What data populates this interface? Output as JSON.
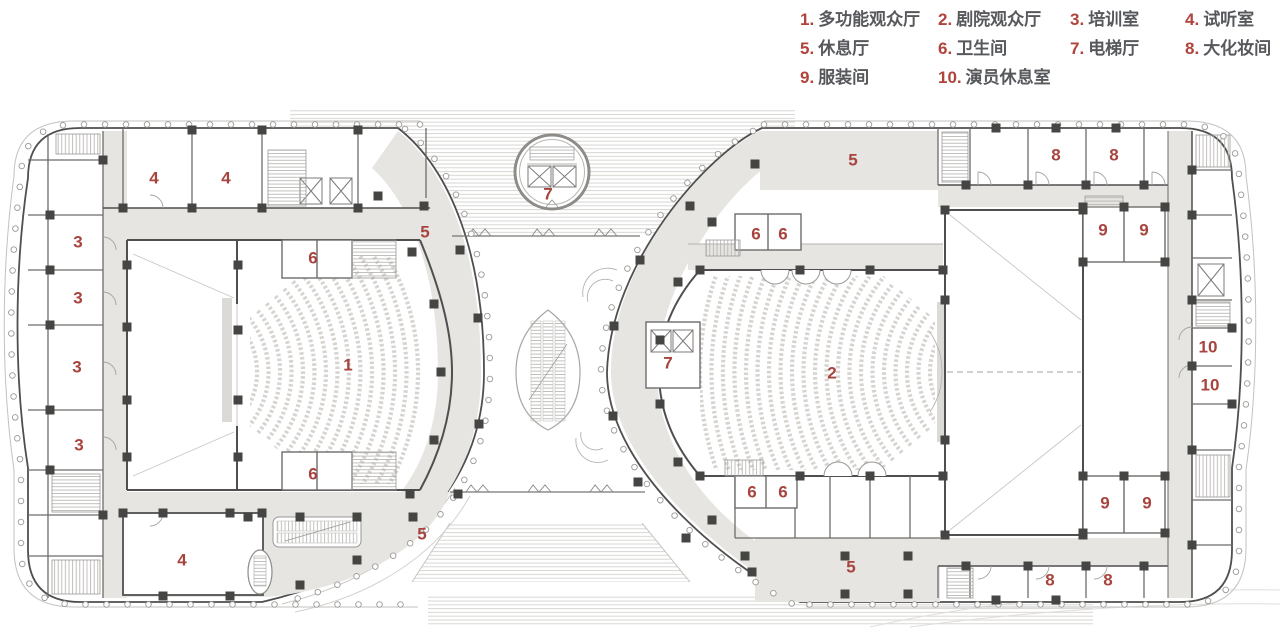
{
  "legend": {
    "items": [
      {
        "num": "1.",
        "label": "多功能观众厅"
      },
      {
        "num": "2.",
        "label": "剧院观众厅"
      },
      {
        "num": "3.",
        "label": "培训室"
      },
      {
        "num": "4.",
        "label": "试听室"
      },
      {
        "num": "5.",
        "label": "休息厅"
      },
      {
        "num": "6.",
        "label": "卫生间"
      },
      {
        "num": "7.",
        "label": "电梯厅"
      },
      {
        "num": "8.",
        "label": "大化妆间"
      },
      {
        "num": "9.",
        "label": "服装间"
      },
      {
        "num": "10.",
        "label": "演员休息室"
      }
    ]
  },
  "plan": {
    "room_labels": [
      {
        "t": "1",
        "x": 348,
        "y": 365
      },
      {
        "t": "2",
        "x": 832,
        "y": 373
      },
      {
        "t": "3",
        "x": 78,
        "y": 242
      },
      {
        "t": "3",
        "x": 78,
        "y": 298
      },
      {
        "t": "3",
        "x": 77,
        "y": 367
      },
      {
        "t": "3",
        "x": 79,
        "y": 445
      },
      {
        "t": "4",
        "x": 154,
        "y": 178
      },
      {
        "t": "4",
        "x": 226,
        "y": 178
      },
      {
        "t": "4",
        "x": 182,
        "y": 560
      },
      {
        "t": "5",
        "x": 425,
        "y": 232
      },
      {
        "t": "5",
        "x": 422,
        "y": 534
      },
      {
        "t": "5",
        "x": 853,
        "y": 160
      },
      {
        "t": "5",
        "x": 851,
        "y": 567
      },
      {
        "t": "6",
        "x": 313,
        "y": 258
      },
      {
        "t": "6",
        "x": 313,
        "y": 474
      },
      {
        "t": "6",
        "x": 756,
        "y": 234
      },
      {
        "t": "6",
        "x": 783,
        "y": 234
      },
      {
        "t": "6",
        "x": 752,
        "y": 492
      },
      {
        "t": "6",
        "x": 783,
        "y": 492
      },
      {
        "t": "7",
        "x": 548,
        "y": 194
      },
      {
        "t": "7",
        "x": 668,
        "y": 363
      },
      {
        "t": "8",
        "x": 1056,
        "y": 155
      },
      {
        "t": "8",
        "x": 1114,
        "y": 155
      },
      {
        "t": "8",
        "x": 1050,
        "y": 580
      },
      {
        "t": "8",
        "x": 1108,
        "y": 580
      },
      {
        "t": "9",
        "x": 1103,
        "y": 230
      },
      {
        "t": "9",
        "x": 1144,
        "y": 230
      },
      {
        "t": "9",
        "x": 1105,
        "y": 503
      },
      {
        "t": "9",
        "x": 1147,
        "y": 503
      },
      {
        "t": "10",
        "x": 1208,
        "y": 347
      },
      {
        "t": "10",
        "x": 1210,
        "y": 385
      }
    ]
  },
  "colors": {
    "label_red": "#a7443e",
    "legend_num_red": "#b0433c",
    "legend_text": "#57585c",
    "corridor_gray": "#e7e5e2",
    "wall_dark": "#4f4f4f",
    "column_dark": "#454543"
  }
}
